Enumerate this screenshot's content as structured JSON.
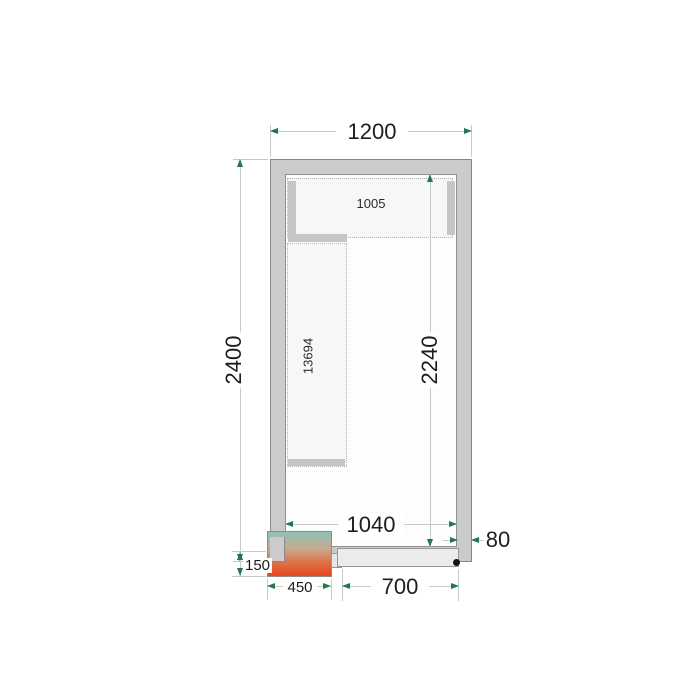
{
  "diagram": {
    "type": "cold-room-floor-plan",
    "labels": {
      "outer_width": "1200",
      "outer_depth": "2400",
      "inner_depth": "2240",
      "inner_width": "1040",
      "door_width": "700",
      "wall_thickness": "80",
      "unit_width": "450",
      "unit_protrusion": "150",
      "top_shelf": "1005",
      "side_shelf": "13694"
    },
    "colors": {
      "wall_fill": "#cbcbcb",
      "door_fill": "#ebebeb",
      "shelf_fill": "#f7f7f7",
      "shelf_support_fill": "#c6c6c6",
      "dimension_line": "#c5ccc7",
      "arrow_green": "#20794a",
      "unit_gradient_top": "#8fc2b6",
      "unit_gradient_middle": "#c7a98e",
      "unit_gradient_bottom": "#e8441c",
      "hinge_dot": "#141414"
    }
  }
}
